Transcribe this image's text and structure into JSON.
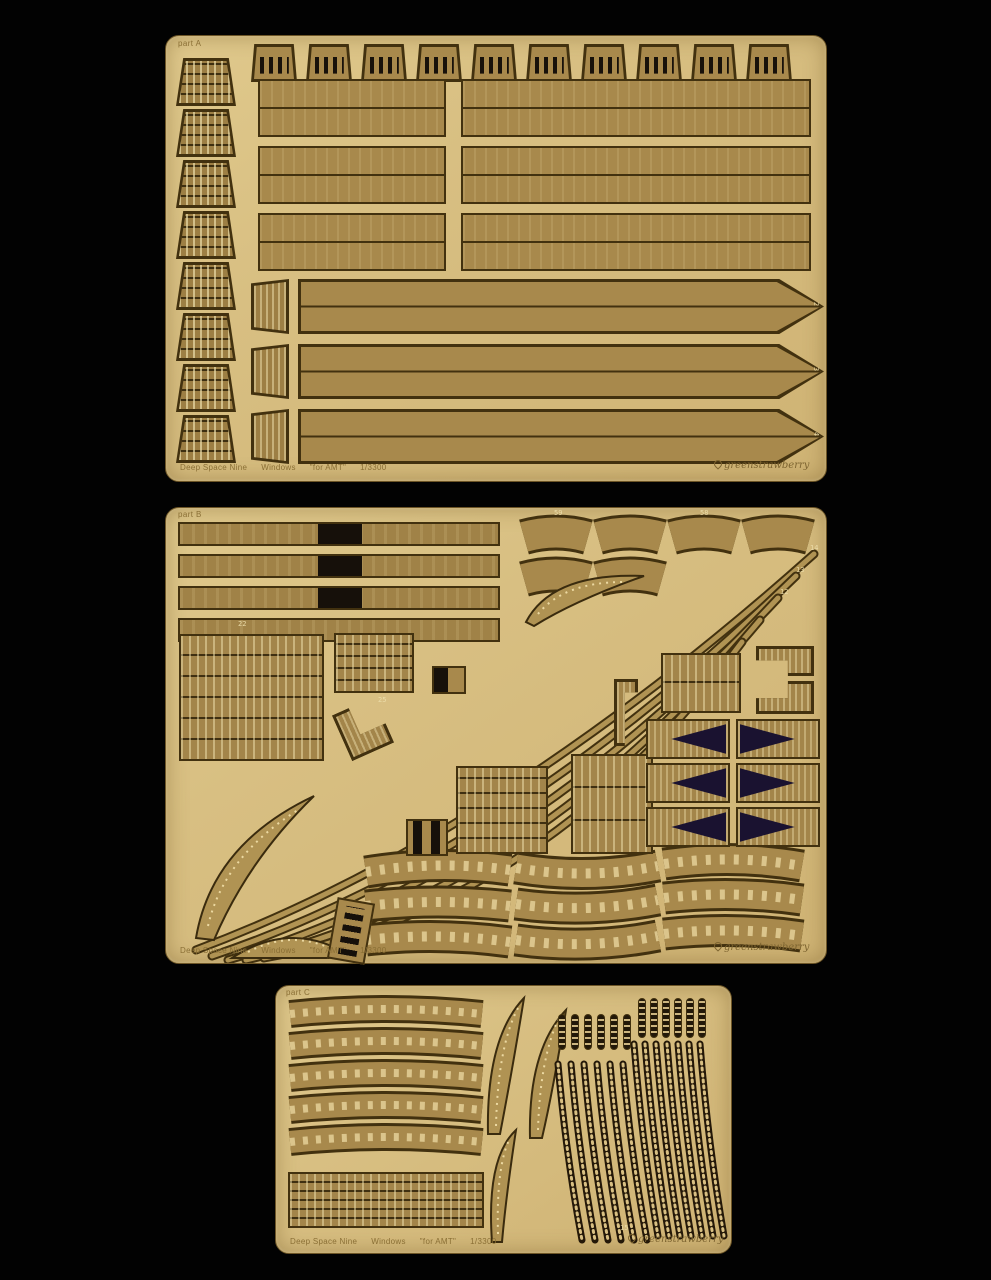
{
  "product": {
    "sheets": [
      {
        "label": "part A"
      },
      {
        "label": "part B"
      },
      {
        "label": "part C"
      }
    ],
    "caption": {
      "title": "Deep Space Nine",
      "subject": "Windows",
      "kit": "\"for AMT\"",
      "scale": "1/3300"
    },
    "brand": "greenstrawberry"
  },
  "numbers": {
    "a_arrows": [
      "2",
      "3",
      "4"
    ],
    "b_top": [
      "59",
      "58"
    ],
    "b_right": [
      "14",
      "13",
      "12"
    ],
    "b_left": [
      "22",
      "25"
    ],
    "c": [
      "15"
    ]
  },
  "colors": {
    "background": "#020202",
    "brass_base": "#d8bf82",
    "brass_part": "#a8894c",
    "outline": "#42310f",
    "etch_cream": "#ecd9a2",
    "cutout_black": "#16100a",
    "film_dark": "#1a1230"
  }
}
